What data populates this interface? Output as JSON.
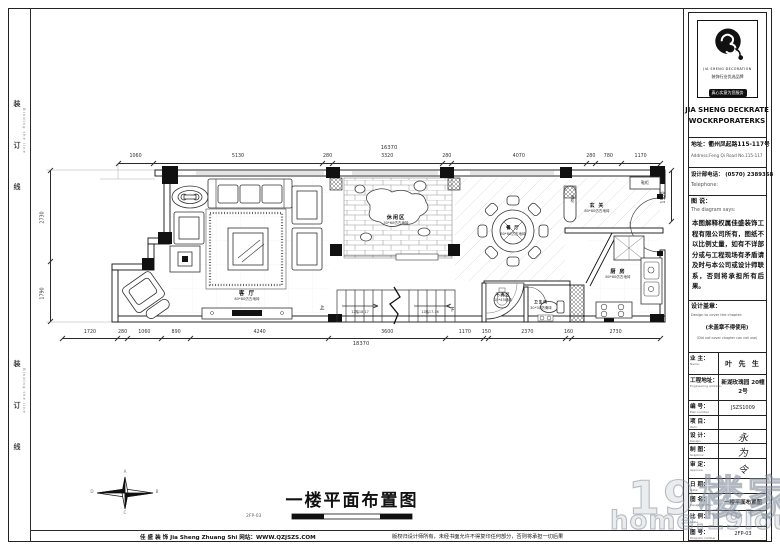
{
  "binding": {
    "label": "装 订 线",
    "label_en": "Binding the line"
  },
  "title_block": {
    "logo": {
      "brand_en": "JIA SHENG DECORATION",
      "slogan1": "装饰行业优选品牌",
      "slogan2": "真心实意为您服务",
      "company_line1": "JIA SHENG DECKRATE",
      "company_line2": "WOCKRPORATERKS"
    },
    "address_cn": "地址：衢州凤起路115-117号",
    "address_en": "Address:Feng Qi Road No.115-117",
    "phone_cn": "设计部电话： (0570) 2389368",
    "phone_en": "Telephone:",
    "says_cn": "图 说：",
    "says_en": "The diagram says:",
    "disclaimer": "本图解释权属佳盛装饰工程有限公司所有，图纸不以比例丈量，如有不详部分或与工程现场有矛盾请及时与本公司或设计师联系，否则将承担所有后果。",
    "seal_cn": "设计盖章：",
    "seal_en": "Design to cover the chapter:",
    "seal_note_cn": "(未盖章不得使用)",
    "seal_note_en": "(Did not cover chapter can not use)",
    "fields": [
      {
        "label": "业 主：",
        "sub": "Name:",
        "value": "叶 先 生",
        "style": "owner"
      },
      {
        "label": "工程地址：",
        "sub": "Engineering address:",
        "value": "新湖玫瑰园 20幢2号",
        "style": "addr"
      },
      {
        "label": "编 号：",
        "sub": "Plan number",
        "value": "JSZS1009",
        "style": "plain"
      },
      {
        "label": "项 目：",
        "sub": "Item",
        "value": "",
        "style": "plain"
      },
      {
        "label": "设 计：",
        "sub": "Design:",
        "value": "永",
        "style": "hand"
      },
      {
        "label": "制 图：",
        "sub": "Graphics:",
        "value": "为",
        "style": "hand"
      },
      {
        "label": "审 定：",
        "sub": "Approve:",
        "value": "令",
        "style": "hand"
      },
      {
        "label": "日 期：",
        "sub": "Date:",
        "value": "",
        "style": "plain"
      },
      {
        "label": "图 名：",
        "sub": "Design for Plan",
        "value": "一楼平面布置图",
        "style": "name"
      },
      {
        "label": "比 例：",
        "sub": "Scale",
        "value": "",
        "style": "plain"
      },
      {
        "label": "图 号：",
        "sub": "Diagram number",
        "value": "2FP-03",
        "style": "plain"
      }
    ]
  },
  "plan": {
    "dims_top": {
      "overall": "16370",
      "segments": [
        "1060",
        "5130",
        "280",
        "3320",
        "280",
        "4070",
        "280",
        "780",
        "1170"
      ]
    },
    "dims_bottom": {
      "overall": "18370",
      "segments": [
        "1720",
        "280",
        "1060",
        "890",
        "4240",
        "3600",
        "1170",
        "150",
        "2370",
        "160",
        "2730"
      ]
    },
    "dims_left": [
      "2730",
      "1790"
    ],
    "dims_right": [
      "1530"
    ],
    "rooms": [
      {
        "name": "客 厅",
        "sub": "80*80仿古地砖"
      },
      {
        "name": "休闲区",
        "sub": "30*60仿古地砖"
      },
      {
        "name": "餐 厅",
        "sub": "80*80仿古地砖"
      },
      {
        "name": "玄 关",
        "sub": "80*80仿古地砖"
      },
      {
        "name": "厨 房",
        "sub": "80*80仿古地砖"
      },
      {
        "name": "干洗区",
        "sub": "13*45墙砖"
      },
      {
        "name": "卫生间",
        "sub": "30*30防滑砖"
      }
    ],
    "cabinets": {
      "shoe": "鞋柜",
      "wine": "酒柜"
    },
    "stairs": {
      "left": "12踏18-17",
      "right": "12踏17-16",
      "down": "下",
      "up": "上"
    },
    "compass": {
      "n": "A",
      "e": "B",
      "s": "C",
      "w": "D"
    }
  },
  "caption": {
    "title": "一楼平面布置图",
    "number": "2FP-03"
  },
  "footer": {
    "left": "佳 盛 装 饰 Jia Sheng Zhuang Shi    网站：WWW.QZJSZS.COM",
    "right": "版权归设计师所有，未经书面允许不得复印任何部分，否则将承担一切后果"
  },
  "watermark": {
    "text": "19楼家居",
    "url": "home.19lou.com"
  }
}
